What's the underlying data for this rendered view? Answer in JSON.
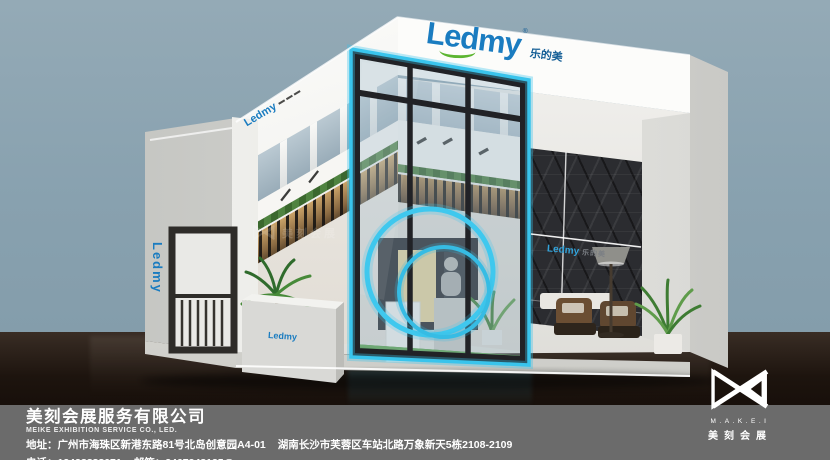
{
  "scene": {
    "sky_color": "#8ba3b1",
    "floor_color": "#15100b",
    "accent_cyan": "#35c3ea",
    "brand_blue": "#1a7cc0",
    "brand_green": "#5cb531"
  },
  "booth": {
    "fascia_logo": "Ledmy",
    "fascia_logo_cn": "乐的美",
    "fascia_logo_reg": "®",
    "side_band_logo": "Ledmy",
    "left_wall_logo": "Ledmy",
    "counter_logo": "Ledmy",
    "feature_wall_logo": "Ledmy",
    "feature_wall_logo_cn": "乐的美"
  },
  "watermark": {
    "text": "美刻会展"
  },
  "footer": {
    "company_cn": "美刻会展服务有限公司",
    "company_en": "MEIKE EXHIBITION SERVICE  CO., LED.",
    "address_label": "地址：",
    "address_1": "广州市海珠区新港东路81号北岛创意园A4-01",
    "address_2": "湖南长沙市芙蓉区车站北路万象新天5栋2108-2109",
    "phone_label": "电话：",
    "phone": "13428888071",
    "email_label": "邮箱：",
    "email": "2467348135@qq.com"
  },
  "agency_logo": {
    "latin": "M.A.K.E.I",
    "cn": "美刻会展"
  }
}
